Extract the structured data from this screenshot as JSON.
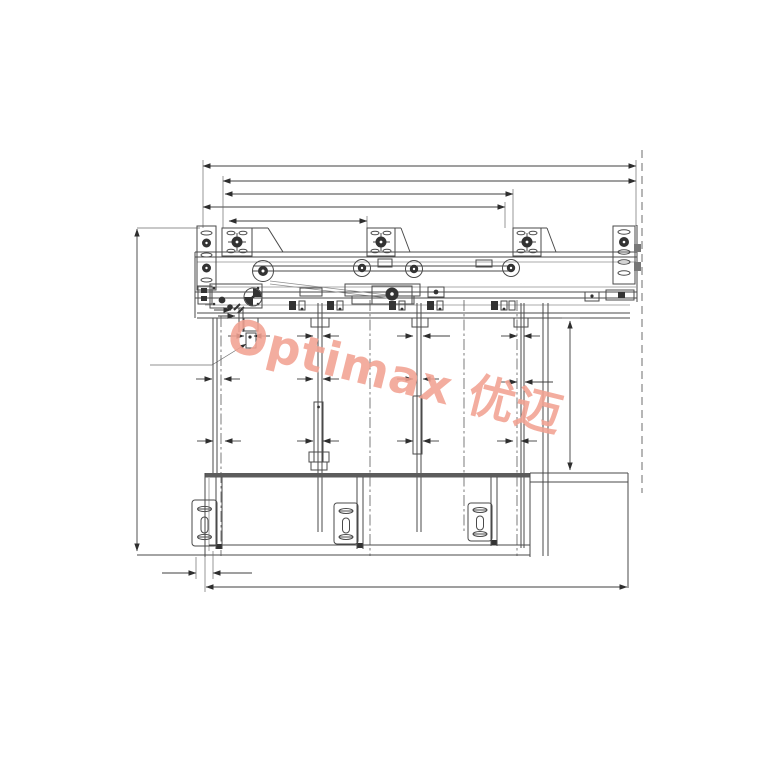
{
  "page": {
    "background": "#ffffff",
    "ink_color": "#4a4a4a"
  },
  "watermark": {
    "text": "Optimax 优迈",
    "color": "#F2A292"
  }
}
